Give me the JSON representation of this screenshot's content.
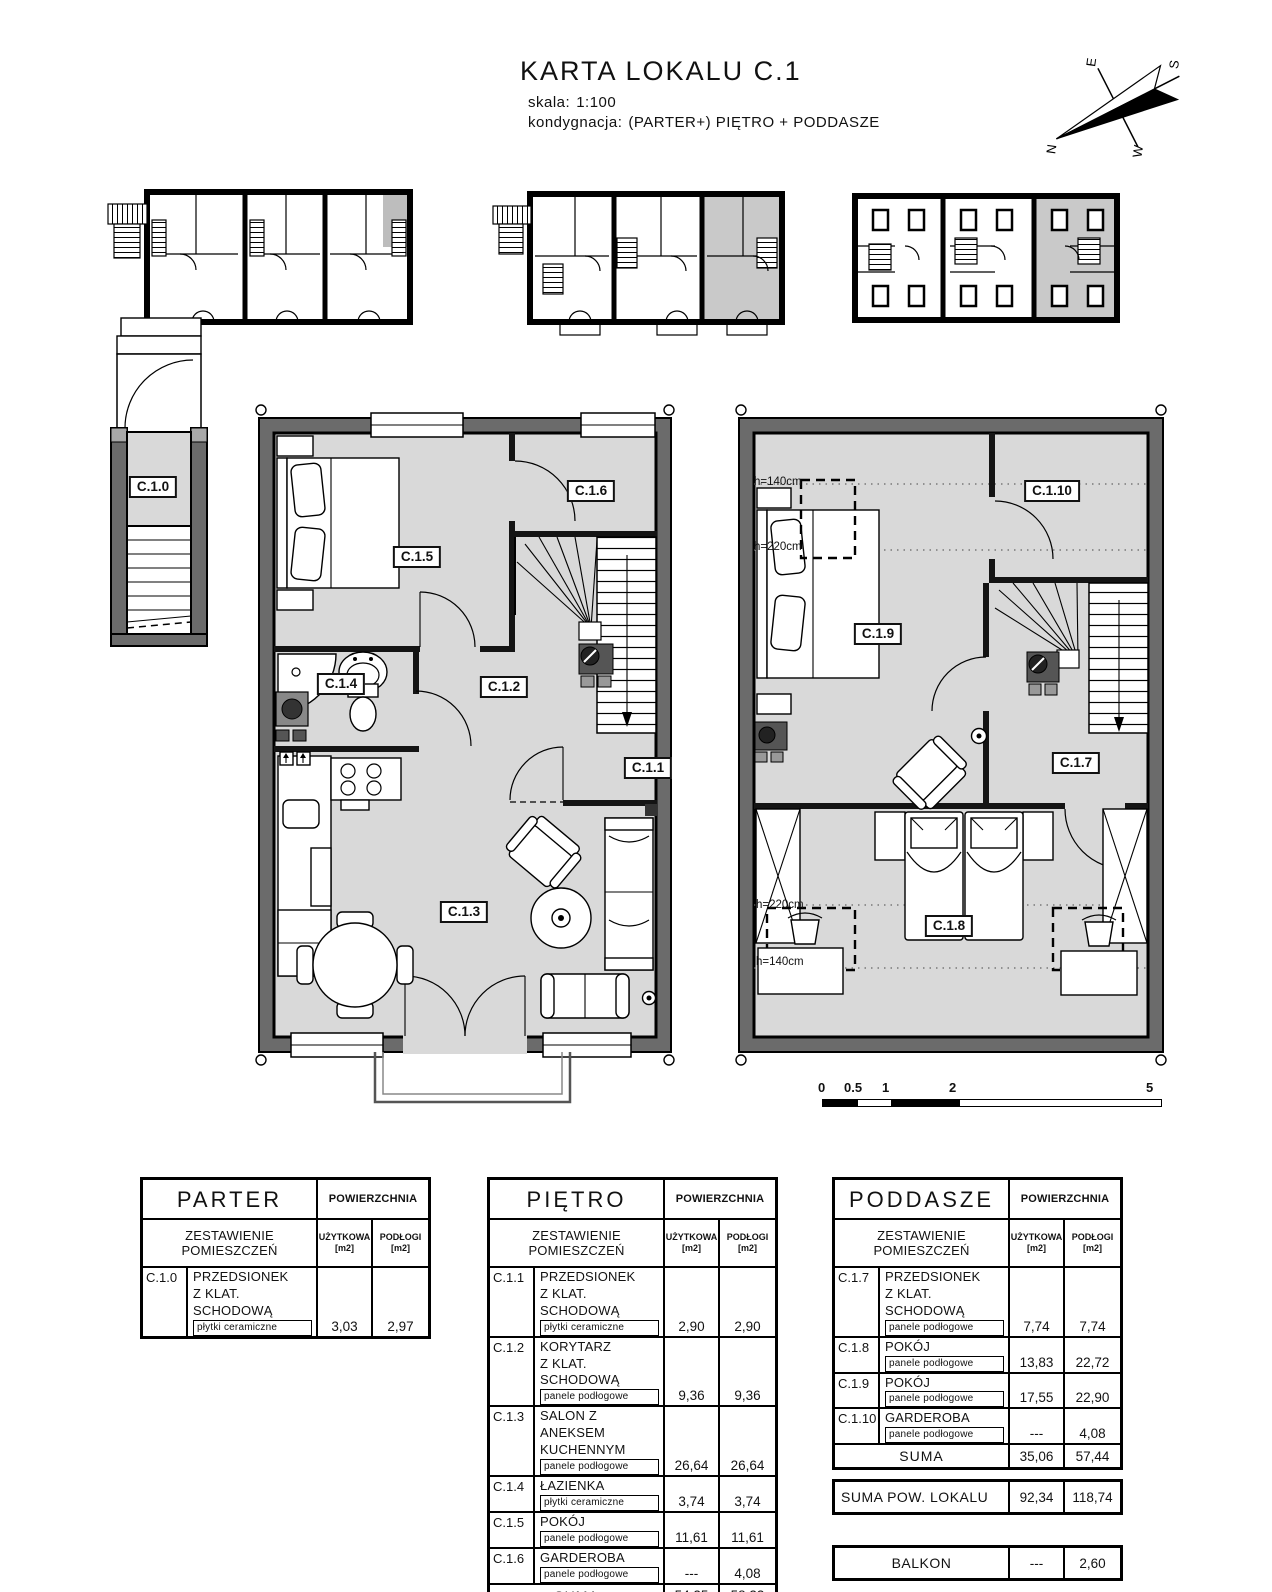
{
  "header": {
    "title": "KARTA LOKALU C.1",
    "scale_label": "skala:",
    "scale_value": "1:100",
    "storey_label": "kondygnacja:",
    "storey_value": "(PARTER+) PIĘTRO + PODDASZE"
  },
  "compass": {
    "n": "N",
    "e": "E",
    "s": "S",
    "w": "W"
  },
  "plan_labels": {
    "c10": "C.1.0",
    "c11": "C.1.1",
    "c12": "C.1.2",
    "c13": "C.1.3",
    "c14": "C.1.4",
    "c15": "C.1.5",
    "c16": "C.1.6",
    "c17": "C.1.7",
    "c18": "C.1.8",
    "c19": "C.1.9",
    "c110": "C.1.10",
    "h140": "h=140cm",
    "h220": "h=220cm"
  },
  "scalebar": {
    "t0": "0",
    "t05": "0.5",
    "t1": "1",
    "t2": "2",
    "t5": "5 m"
  },
  "table_headers": {
    "area": "POWIERZCHNIA",
    "list": "ZESTAWIENIE POMIESZCZEŃ",
    "col1": "UŻYTKOWA",
    "col1_unit": "[m2]",
    "col2": "PODŁOGI",
    "col2_unit": "[m2]",
    "suma": "SUMA"
  },
  "tables": [
    {
      "title": "PARTER",
      "rows": [
        {
          "code": "C.1.0",
          "name": [
            "PRZEDSIONEK",
            "Z KLAT. SCHODOWĄ"
          ],
          "finish": "płytki ceramiczne",
          "u": "3,03",
          "p": "2,97"
        }
      ],
      "suma": null
    },
    {
      "title": "PIĘTRO",
      "rows": [
        {
          "code": "C.1.1",
          "name": [
            "PRZEDSIONEK",
            "Z KLAT. SCHODOWĄ"
          ],
          "finish": "płytki ceramiczne",
          "u": "2,90",
          "p": "2,90"
        },
        {
          "code": "C.1.2",
          "name": [
            "KORYTARZ",
            "Z KLAT. SCHODOWĄ"
          ],
          "finish": "panele podłogowe",
          "u": "9,36",
          "p": "9,36"
        },
        {
          "code": "C.1.3",
          "name": [
            "SALON Z ANEKSEM",
            "KUCHENNYM"
          ],
          "finish": "panele podłogowe",
          "u": "26,64",
          "p": "26,64"
        },
        {
          "code": "C.1.4",
          "name": [
            "ŁAZIENKA"
          ],
          "finish": "płytki ceramiczne",
          "u": "3,74",
          "p": "3,74"
        },
        {
          "code": "C.1.5",
          "name": [
            "POKÓJ"
          ],
          "finish": "panele podłogowe",
          "u": "11,61",
          "p": "11,61"
        },
        {
          "code": "C.1.6",
          "name": [
            "GARDEROBA"
          ],
          "finish": "panele podłogowe",
          "u": "---",
          "p": "4,08"
        }
      ],
      "suma": {
        "u": "54,25",
        "p": "58,33"
      }
    },
    {
      "title": "PODDASZE",
      "rows": [
        {
          "code": "C.1.7",
          "name": [
            "PRZEDSIONEK",
            "Z KLAT. SCHODOWĄ"
          ],
          "finish": "panele podłogowe",
          "u": "7,74",
          "p": "7,74"
        },
        {
          "code": "C.1.8",
          "name": [
            "POKÓJ"
          ],
          "finish": "panele podłogowe",
          "u": "13,83",
          "p": "22,72"
        },
        {
          "code": "C.1.9",
          "name": [
            "POKÓJ"
          ],
          "finish": "panele podłogowe",
          "u": "17,55",
          "p": "22,90"
        },
        {
          "code": "C.1.10",
          "name": [
            "GARDEROBA"
          ],
          "finish": "panele podłogowe",
          "u": "---",
          "p": "4,08"
        }
      ],
      "suma": {
        "u": "35,06",
        "p": "57,44"
      }
    }
  ],
  "summary": {
    "label": "SUMA POW. LOKALU",
    "u": "92,34",
    "p": "118,74"
  },
  "balkon": {
    "label": "BALKON",
    "u": "---",
    "p": "2,60"
  }
}
